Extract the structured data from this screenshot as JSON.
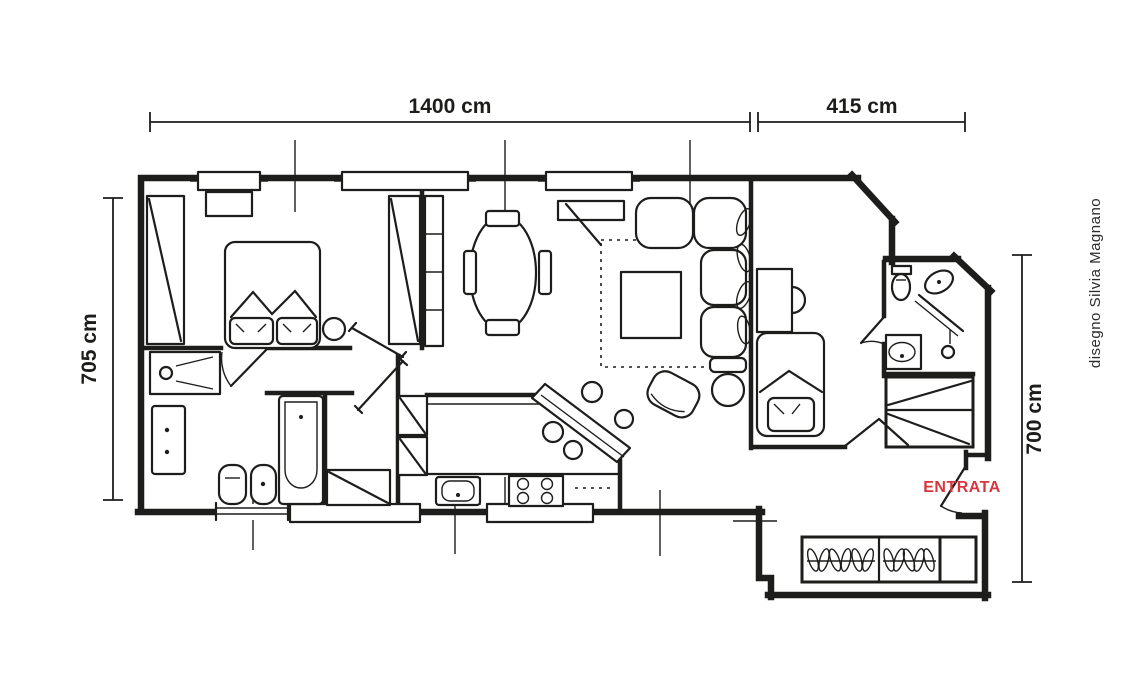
{
  "dimensions": {
    "top_main": "1400 cm",
    "top_right": "415 cm",
    "left": "705 cm",
    "right": "700 cm"
  },
  "labels": {
    "entrance": "ENTRATA",
    "credit": "disegno Silvia Magnano"
  },
  "colors": {
    "line": "#1d1d1b",
    "entrance_red": "#d9353d",
    "background": "#ffffff"
  }
}
